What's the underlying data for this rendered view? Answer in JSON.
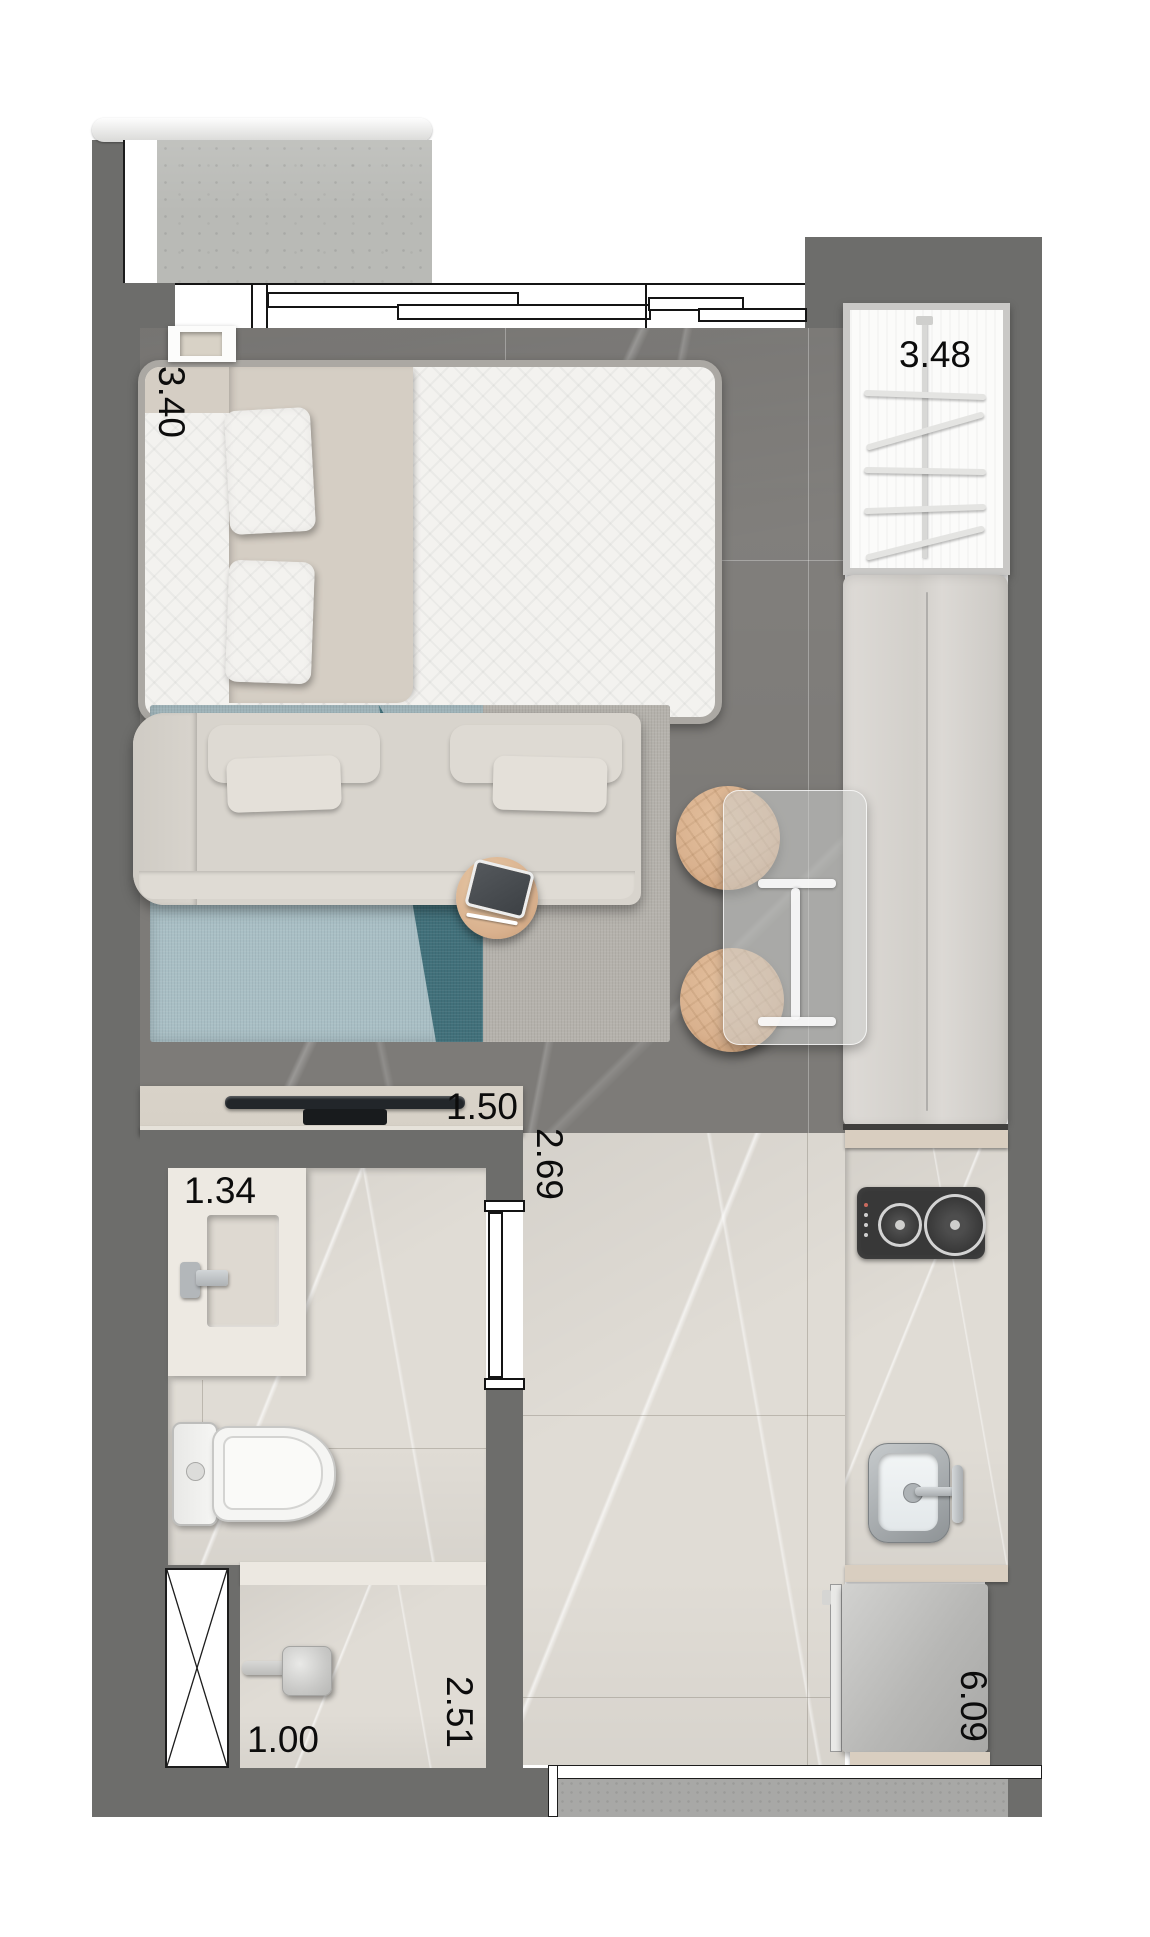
{
  "dimensions": {
    "bedroom_width": "3.40",
    "wardrobe_width": "3.48",
    "tv_wall_width": "1.50",
    "hall_width": "2.69",
    "vanity_width": "1.34",
    "shower_width": "1.00",
    "bathroom_length": "2.51",
    "apartment_length": "6.09"
  },
  "colors": {
    "wall": "#6d6d6b",
    "floor_dark": "#7d7b78",
    "floor_light": "#e0dcd5",
    "concrete": "#b9bab6",
    "bed_white": "#f3f2ef",
    "beige": "#d5cec4",
    "sofa": "#d8d4cd",
    "rug_blue": "#a9bfc5",
    "rug_teal": "#41707a",
    "rug_gray": "#b5b2ac",
    "wood": "#d9b18e",
    "console": "#d6d0c6",
    "counter_edge": "#d9cec0",
    "cooktop": "#383838",
    "steel": "#b9bdc0",
    "bench": "#d8d5d1",
    "wardrobe_border": "#c9c8c6",
    "mat": "#a8a8a6",
    "label": "#0c0c0c"
  }
}
